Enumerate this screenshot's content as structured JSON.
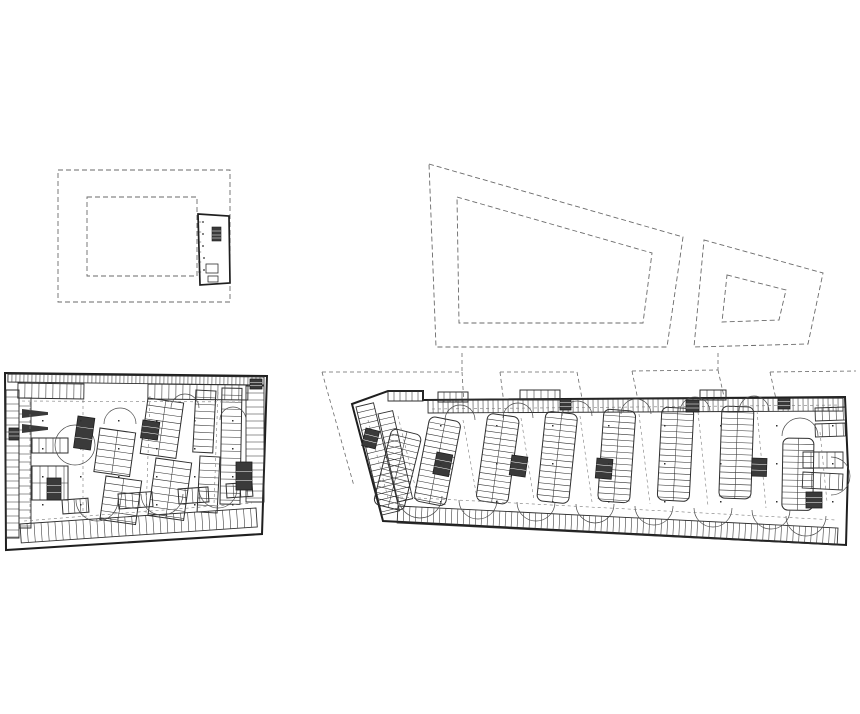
{
  "drawing": {
    "kind": "architectural-plan-sheet",
    "colors": {
      "bg": "#ffffff",
      "wall": "#1f1f1f",
      "line": "#2f2f2f",
      "thin": "#3a3a3a",
      "arc": "#4a4a4a",
      "dash": "#6a6a6a",
      "aisle_dash": "#7a7a7a",
      "core_fill": "#3a3a3a"
    },
    "upper_left_site": {
      "outer_rect": [
        58,
        170,
        172,
        132
      ],
      "inner_rect": [
        87,
        197,
        110,
        79
      ],
      "building": {
        "outline": [
          [
            198,
            214
          ],
          [
            229,
            216
          ],
          [
            230,
            283
          ],
          [
            200,
            285
          ]
        ],
        "column_dots": [
          [
            203,
            222
          ],
          [
            203,
            234
          ],
          [
            203,
            246
          ],
          [
            204,
            258
          ],
          [
            204,
            270
          ]
        ],
        "dark_block": [
          212,
          227,
          9,
          14
        ],
        "furniture": [
          [
            206,
            264,
            12,
            9
          ],
          [
            208,
            276,
            10,
            6
          ]
        ],
        "wall_tick_ys": [
          222,
          232,
          242,
          252,
          262,
          272
        ]
      }
    },
    "upper_right_site": {
      "large_outer": [
        [
          429,
          164
        ],
        [
          683,
          237
        ],
        [
          667,
          347
        ],
        [
          436,
          347
        ]
      ],
      "large_inner": [
        [
          457,
          197
        ],
        [
          652,
          253
        ],
        [
          643,
          323
        ],
        [
          459,
          323
        ]
      ],
      "small_outer": [
        [
          704,
          240
        ],
        [
          823,
          273
        ],
        [
          808,
          344
        ],
        [
          694,
          347
        ]
      ],
      "small_inner": [
        [
          727,
          275
        ],
        [
          786,
          290
        ],
        [
          779,
          320
        ],
        [
          722,
          322
        ]
      ]
    },
    "left_plan": {
      "boundary": [
        [
          5,
          373
        ],
        [
          267,
          376
        ],
        [
          262,
          534
        ],
        [
          6,
          550
        ]
      ],
      "bands": [
        [
          8,
          374,
          264,
          377,
          8,
          4
        ],
        [
          18,
          383,
          84,
          384,
          15,
          7
        ],
        [
          148,
          384,
          248,
          385,
          15,
          7
        ],
        [
          6,
          390,
          6,
          538,
          13,
          7
        ],
        [
          19,
          398,
          19,
          528,
          12,
          8
        ],
        [
          246,
          386,
          246,
          502,
          18,
          7
        ],
        [
          20,
          524,
          256,
          508,
          19,
          7
        ]
      ],
      "islands": [
        [
          32,
          438,
          36,
          15,
          0,
          7
        ],
        [
          32,
          466,
          36,
          34,
          0,
          8
        ],
        [
          100,
          428,
          36,
          44,
          8,
          7
        ],
        [
          106,
          476,
          36,
          44,
          8,
          7
        ],
        [
          148,
          398,
          36,
          56,
          8,
          7
        ],
        [
          156,
          458,
          36,
          58,
          8,
          7
        ],
        [
          196,
          390,
          20,
          62,
          3,
          7
        ],
        [
          200,
          456,
          20,
          56,
          3,
          7
        ],
        [
          222,
          388,
          20,
          116,
          1,
          7
        ]
      ],
      "clusters": [
        [
          62,
          500,
          26,
          14,
          -4,
          6
        ],
        [
          118,
          494,
          34,
          15,
          -4,
          7
        ],
        [
          178,
          489,
          30,
          15,
          -4,
          7
        ],
        [
          226,
          484,
          26,
          14,
          -4,
          7
        ]
      ],
      "cores": [
        [
          78,
          416,
          17,
          32,
          8
        ],
        [
          143,
          420,
          17,
          18,
          8
        ],
        [
          236,
          462,
          16,
          28,
          0
        ],
        [
          47,
          478,
          14,
          22,
          0
        ],
        [
          9,
          428,
          10,
          12,
          0
        ],
        [
          250,
          379,
          12,
          10,
          0
        ]
      ],
      "ramps": [
        [
          22,
          409,
          26,
          9
        ],
        [
          22,
          424,
          26,
          9
        ]
      ],
      "arcs": [
        [
          75,
          445,
          20,
          "circle"
        ],
        [
          97,
          500,
          21,
          "down"
        ],
        [
          162,
          494,
          21,
          "down"
        ],
        [
          218,
          489,
          19,
          "down"
        ],
        [
          120,
          424,
          16,
          "up"
        ],
        [
          185,
          408,
          14,
          "up"
        ],
        [
          233,
          420,
          13,
          "up"
        ]
      ],
      "aisles": [
        [
          [
            22,
            401
          ],
          [
            243,
            402
          ]
        ],
        [
          [
            83,
            400
          ],
          [
            83,
            520
          ]
        ],
        [
          [
            150,
            396
          ],
          [
            146,
            514
          ]
        ],
        [
          [
            218,
            392
          ],
          [
            214,
            504
          ]
        ],
        [
          [
            30,
            402
          ],
          [
            30,
            524
          ]
        ],
        [
          [
            24,
            521
          ],
          [
            252,
            503
          ]
        ]
      ],
      "dot_grid": {
        "x0": 42,
        "y0": 420,
        "dx": 38,
        "dy": 28,
        "nx": 6,
        "ny": 4
      }
    },
    "right_plan": {
      "boundary": [
        [
          352,
          404
        ],
        [
          388,
          391
        ],
        [
          423,
          391
        ],
        [
          423,
          400
        ],
        [
          845,
          397
        ],
        [
          848,
          468
        ],
        [
          846,
          545
        ],
        [
          383,
          521
        ]
      ],
      "bands": [
        [
          428,
          400,
          843,
          398,
          13,
          5
        ],
        [
          388,
          391,
          423,
          391,
          10,
          6
        ],
        [
          398,
          506,
          838,
          528,
          17,
          6
        ],
        [
          356,
          407,
          382,
          515,
          18,
          6
        ],
        [
          378,
          414,
          398,
          502,
          15,
          6
        ],
        [
          815,
          408,
          845,
          407,
          13,
          7
        ],
        [
          815,
          424,
          845,
          423,
          13,
          7
        ],
        [
          803,
          452,
          843,
          452,
          16,
          8
        ],
        [
          803,
          472,
          843,
          474,
          16,
          9
        ]
      ],
      "islands": [
        [
          392,
          428,
          31,
          78,
          14,
          6
        ],
        [
          430,
          416,
          32,
          86,
          11,
          6
        ],
        [
          488,
          413,
          32,
          88,
          8,
          6
        ],
        [
          546,
          411,
          32,
          90,
          6,
          6
        ],
        [
          604,
          409,
          32,
          92,
          4,
          6
        ],
        [
          662,
          407,
          32,
          93,
          3,
          6
        ],
        [
          722,
          406,
          32,
          92,
          2,
          6
        ],
        [
          783,
          438,
          31,
          72,
          1,
          6
        ]
      ],
      "clusters": [
        [
          438,
          392,
          30,
          10,
          0,
          6
        ],
        [
          520,
          390,
          40,
          10,
          0,
          7
        ],
        [
          700,
          390,
          26,
          10,
          0,
          7
        ]
      ],
      "cores": [
        [
          437,
          452,
          16,
          22,
          11
        ],
        [
          512,
          455,
          16,
          20,
          8
        ],
        [
          597,
          458,
          16,
          20,
          5
        ],
        [
          686,
          400,
          13,
          12,
          0
        ],
        [
          778,
          398,
          12,
          11,
          0
        ],
        [
          752,
          458,
          15,
          18,
          2
        ],
        [
          806,
          492,
          16,
          16,
          0
        ],
        [
          366,
          428,
          14,
          18,
          14
        ],
        [
          560,
          399,
          11,
          11,
          0
        ]
      ],
      "ramps": [],
      "arcs": [
        [
          478,
          500,
          19,
          "down"
        ],
        [
          536,
          502,
          19,
          "down"
        ],
        [
          595,
          504,
          19,
          "down"
        ],
        [
          654,
          506,
          19,
          "down"
        ],
        [
          713,
          508,
          19,
          "down"
        ],
        [
          771,
          510,
          19,
          "down"
        ],
        [
          420,
          496,
          22,
          "down"
        ],
        [
          460,
          420,
          15,
          "up"
        ],
        [
          518,
          418,
          15,
          "up"
        ],
        [
          577,
          416,
          15,
          "up"
        ],
        [
          636,
          414,
          15,
          "up"
        ],
        [
          695,
          412,
          15,
          "up"
        ],
        [
          754,
          411,
          15,
          "up"
        ],
        [
          800,
          436,
          18,
          "up"
        ],
        [
          806,
          516,
          20,
          "down"
        ],
        [
          831,
          476,
          19,
          "right"
        ]
      ],
      "aisles": [
        [
          [
            432,
            409
          ],
          [
            840,
            405
          ]
        ],
        [
          [
            400,
            497
          ],
          [
            836,
            520
          ]
        ],
        [
          [
            463,
            420
          ],
          [
            477,
            498
          ]
        ],
        [
          [
            521,
            418
          ],
          [
            534,
            500
          ]
        ],
        [
          [
            580,
            416
          ],
          [
            592,
            502
          ]
        ],
        [
          [
            639,
            414
          ],
          [
            650,
            504
          ]
        ],
        [
          [
            698,
            412
          ],
          [
            708,
            506
          ]
        ],
        [
          [
            757,
            411
          ],
          [
            766,
            508
          ]
        ],
        [
          [
            398,
            416
          ],
          [
            417,
            494
          ]
        ],
        [
          [
            820,
            432
          ],
          [
            827,
            502
          ]
        ],
        [
          [
            368,
            420
          ],
          [
            390,
            506
          ]
        ]
      ],
      "dot_grid": {
        "x0": 440,
        "y0": 425,
        "dx": 56,
        "dy": 38,
        "nx": 8,
        "ny": 3
      },
      "projections": [
        [
          [
            322,
            372
          ],
          [
            462,
            372
          ]
        ],
        [
          [
            322,
            372
          ],
          [
            354,
            486
          ]
        ],
        [
          [
            462,
            353
          ],
          [
            462,
            372
          ]
        ],
        [
          [
            462,
            372
          ],
          [
            470,
            500
          ]
        ],
        [
          [
            500,
            372
          ],
          [
            577,
            372
          ]
        ],
        [
          [
            500,
            372
          ],
          [
            512,
            468
          ]
        ],
        [
          [
            577,
            372
          ],
          [
            596,
            472
          ]
        ],
        [
          [
            632,
            371
          ],
          [
            718,
            370
          ]
        ],
        [
          [
            632,
            371
          ],
          [
            652,
            468
          ]
        ],
        [
          [
            718,
            353
          ],
          [
            718,
            370
          ]
        ],
        [
          [
            718,
            370
          ],
          [
            740,
            468
          ]
        ],
        [
          [
            770,
            372
          ],
          [
            856,
            371
          ]
        ],
        [
          [
            770,
            372
          ],
          [
            790,
            462
          ]
        ]
      ]
    }
  }
}
